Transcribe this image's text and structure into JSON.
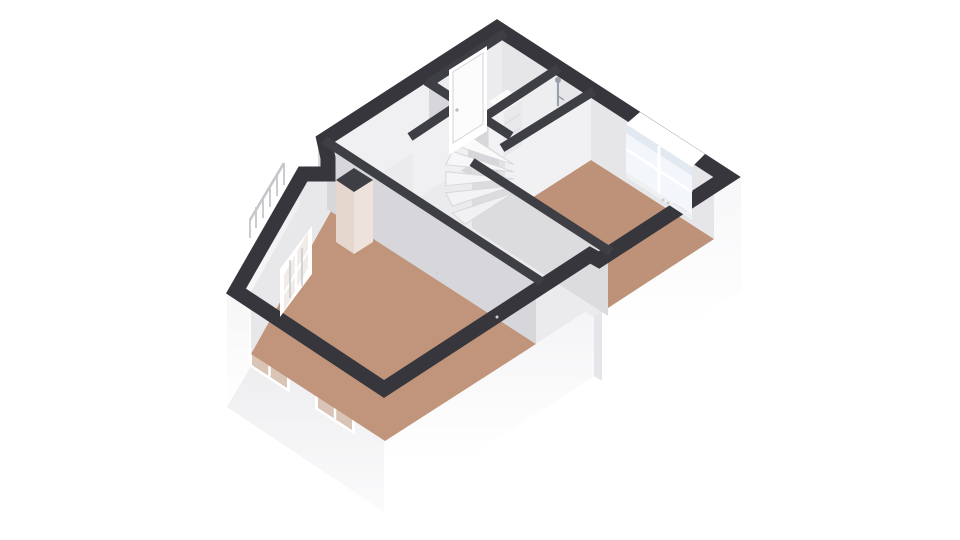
{
  "scene": {
    "type": "3d-floor-plan",
    "view": "axonometric-top",
    "background": "#ffffff"
  },
  "palette": {
    "wall_dark": "#36363c",
    "wall_dark_int": "#3e3e45",
    "face_back": "#e6e6e9",
    "face_back_light": "#f0f0f2",
    "face_mid": "#d7d7db",
    "face_light": "#efeff1",
    "face_lighter": "#e2e2e5",
    "ext_sw": "#e9e9ec",
    "ext_light": "#f4f4f6",
    "floor_wood": "#c0957b",
    "floor_wood2": "#bd9278",
    "floor_bath": "#aec9e0",
    "floor_shower": "#dde2e7",
    "floor_hall": "#ebebed",
    "stair_tread": "#f5f5f7",
    "stair_edge": "#d8d8db",
    "glass": "#f3f7fb",
    "glass_through": "#d9c4b6",
    "glass_diag": "#f1ece8",
    "frame_white": "#ffffff",
    "door_white": "#fcfcfd",
    "cabinet_white": "#fbfbfc",
    "column_tint": "#e5d6ce",
    "column_tint2": "#eee3dc",
    "fixture_gray": "#98a0a9",
    "railing": "#c6c6cb",
    "dot": "#cfcfd3"
  },
  "rooms": [
    {
      "name": "bedroom-left",
      "floor": "wood"
    },
    {
      "name": "bedroom-right",
      "floor": "wood"
    },
    {
      "name": "bathroom",
      "floor": "blue-tile"
    },
    {
      "name": "shower-room",
      "floor": "gray-tile"
    },
    {
      "name": "stair-hall-landing",
      "floor": "light"
    }
  ],
  "features": {
    "staircase": "winder-spiral",
    "stair_treads": 5,
    "windows_total": 5,
    "facade_windows": 2,
    "doors": 1,
    "boiler_cabinet": 1,
    "shower_fixture": 1,
    "duct_column": 1,
    "exterior_railing_posts": 6
  }
}
